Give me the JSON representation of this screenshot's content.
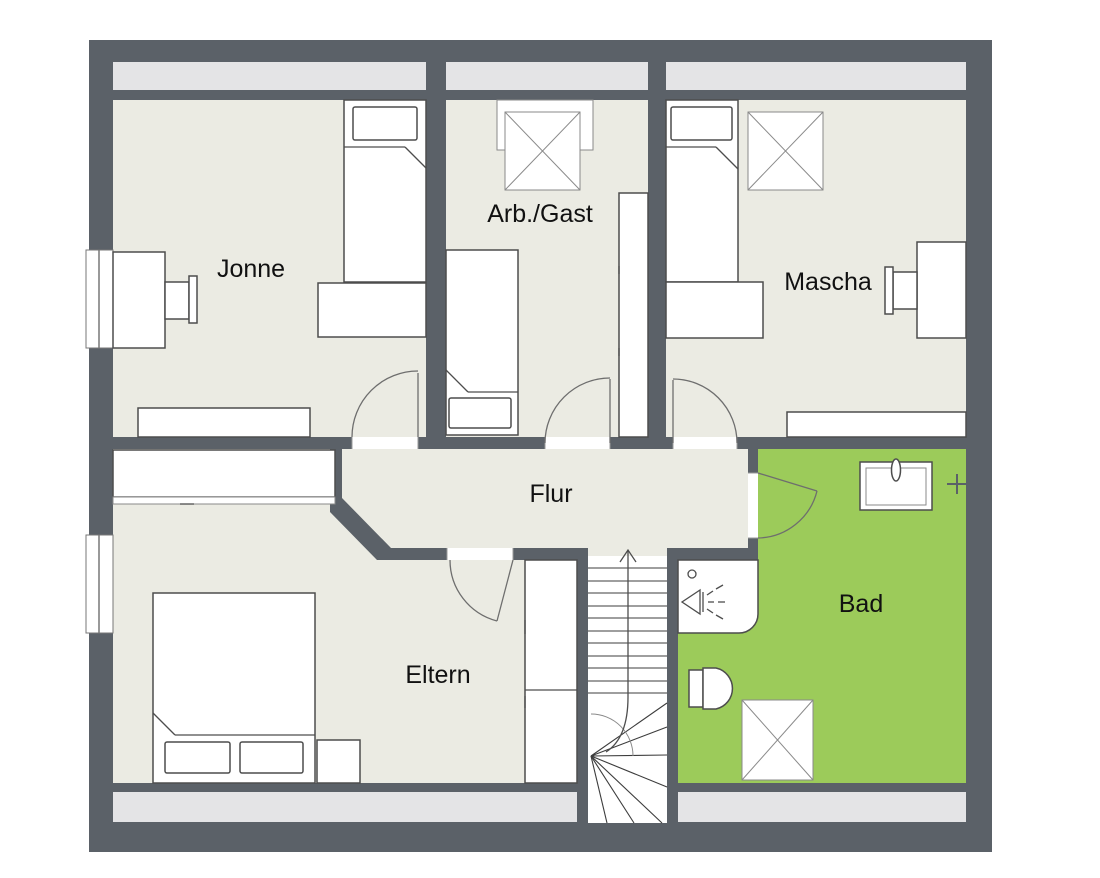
{
  "plan": {
    "title": "attic floor plan",
    "rooms": {
      "jonne": {
        "label": "Jonne"
      },
      "arbgast": {
        "label": "Arb./Gast"
      },
      "mascha": {
        "label": "Mascha"
      },
      "flur": {
        "label": "Flur"
      },
      "eltern": {
        "label": "Eltern"
      },
      "bad": {
        "label": "Bad"
      }
    },
    "stairs": {
      "direction": "up"
    },
    "fixture_icons": [
      "single-bed-icon",
      "double-bed-icon",
      "pillow-icon",
      "blanket-fold-icon",
      "desk-icon",
      "chair-icon",
      "wardrobe-icon",
      "sideboard-icon",
      "dresser-icon",
      "nightstand-icon",
      "roof-window-icon",
      "window-icon",
      "door-swing-icon",
      "stairs-icon",
      "up-arrow-icon",
      "shower-icon",
      "shower-drain-icon",
      "shower-spray-icon",
      "toilet-icon",
      "washbasin-icon",
      "faucet-icon",
      "cross-valve-icon"
    ]
  },
  "colors": {
    "wall": "#5b6168",
    "floor": "#ebebe3",
    "strip": "#e4e4e6",
    "bad_floor": "#9ccb5a",
    "page": "#ffffff"
  }
}
